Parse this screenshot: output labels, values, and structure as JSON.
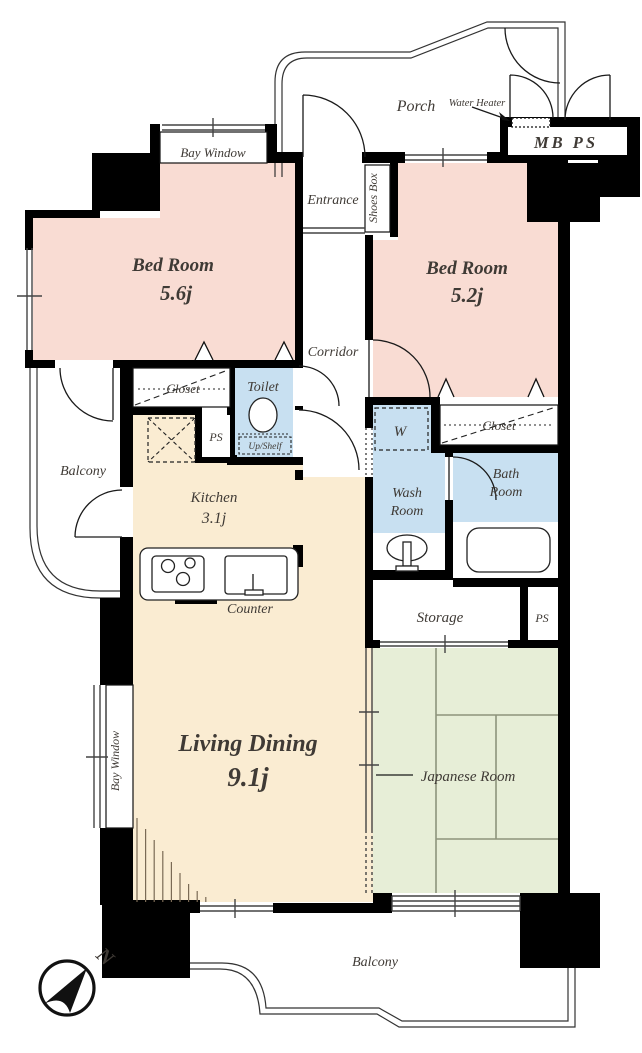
{
  "floorplan": {
    "rooms": {
      "bedroom1": {
        "name": "Bed Room",
        "size": "5.6j"
      },
      "bedroom2": {
        "name": "Bed Room",
        "size": "5.2j"
      },
      "living_dining": {
        "name": "Living Dining",
        "size": "9.1j"
      },
      "kitchen": {
        "name": "Kitchen",
        "size": "3.1j"
      },
      "japanese_room": {
        "name": "Japanese Room"
      },
      "wash_room": {
        "line1": "Wash",
        "line2": "Room"
      },
      "bath_room": {
        "line1": "Bath",
        "line2": "Room"
      },
      "toilet": "Toilet",
      "storage": "Storage",
      "entrance": "Entrance",
      "corridor": "Corridor",
      "porch": "Porch",
      "balcony_left": "Balcony",
      "balcony_bottom": "Balcony"
    },
    "labels": {
      "bay_window_top": "Bay Window",
      "bay_window_left": "Bay Window",
      "shoes_box": "Shoes Box",
      "closet_left": "Closet",
      "closet_right": "Closet",
      "water_heater": "Water Heater",
      "mb_ps": "MB PS",
      "ps_kitchen": "PS",
      "ps_storage": "PS",
      "up_shelf": "Up/Shelf",
      "washer": "W",
      "counter": "Counter",
      "north": "N"
    },
    "colors": {
      "bedroom": "#f9dcd3",
      "living": "#faecd2",
      "wet_area": "#c8e0f1",
      "tatami": "#e7eed7",
      "tatami_line": "#8d947c",
      "wall": "#000000",
      "text": "#3f3a35"
    }
  }
}
